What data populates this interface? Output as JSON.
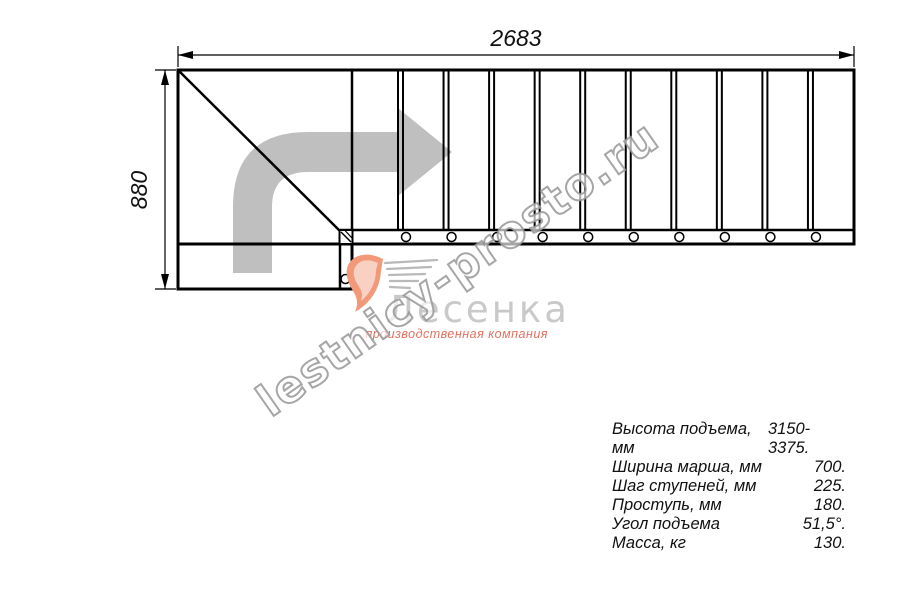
{
  "dimensions": {
    "width_label": "2683",
    "height_label": "880"
  },
  "drawing": {
    "type": "staircase-plan-view",
    "step_divisions": 10,
    "tread_count": 11,
    "bolt_count": 10,
    "turn_direction": "up-then-right"
  },
  "logo": {
    "name": "Лесенка",
    "tagline": "производственная компания"
  },
  "watermark": {
    "text": "lestnicy-prosto.ru"
  },
  "specs": {
    "rows": [
      {
        "label": "Высота подъема, мм",
        "value": "3150-3375."
      },
      {
        "label": "Ширина марша, мм",
        "value": "700."
      },
      {
        "label": "Шаг ступеней, мм",
        "value": "225."
      },
      {
        "label": "Проступь, мм",
        "value": "180."
      },
      {
        "label": "Угол подъема",
        "value": "51,5°."
      },
      {
        "label": "Масса, кг",
        "value": "130."
      }
    ]
  }
}
